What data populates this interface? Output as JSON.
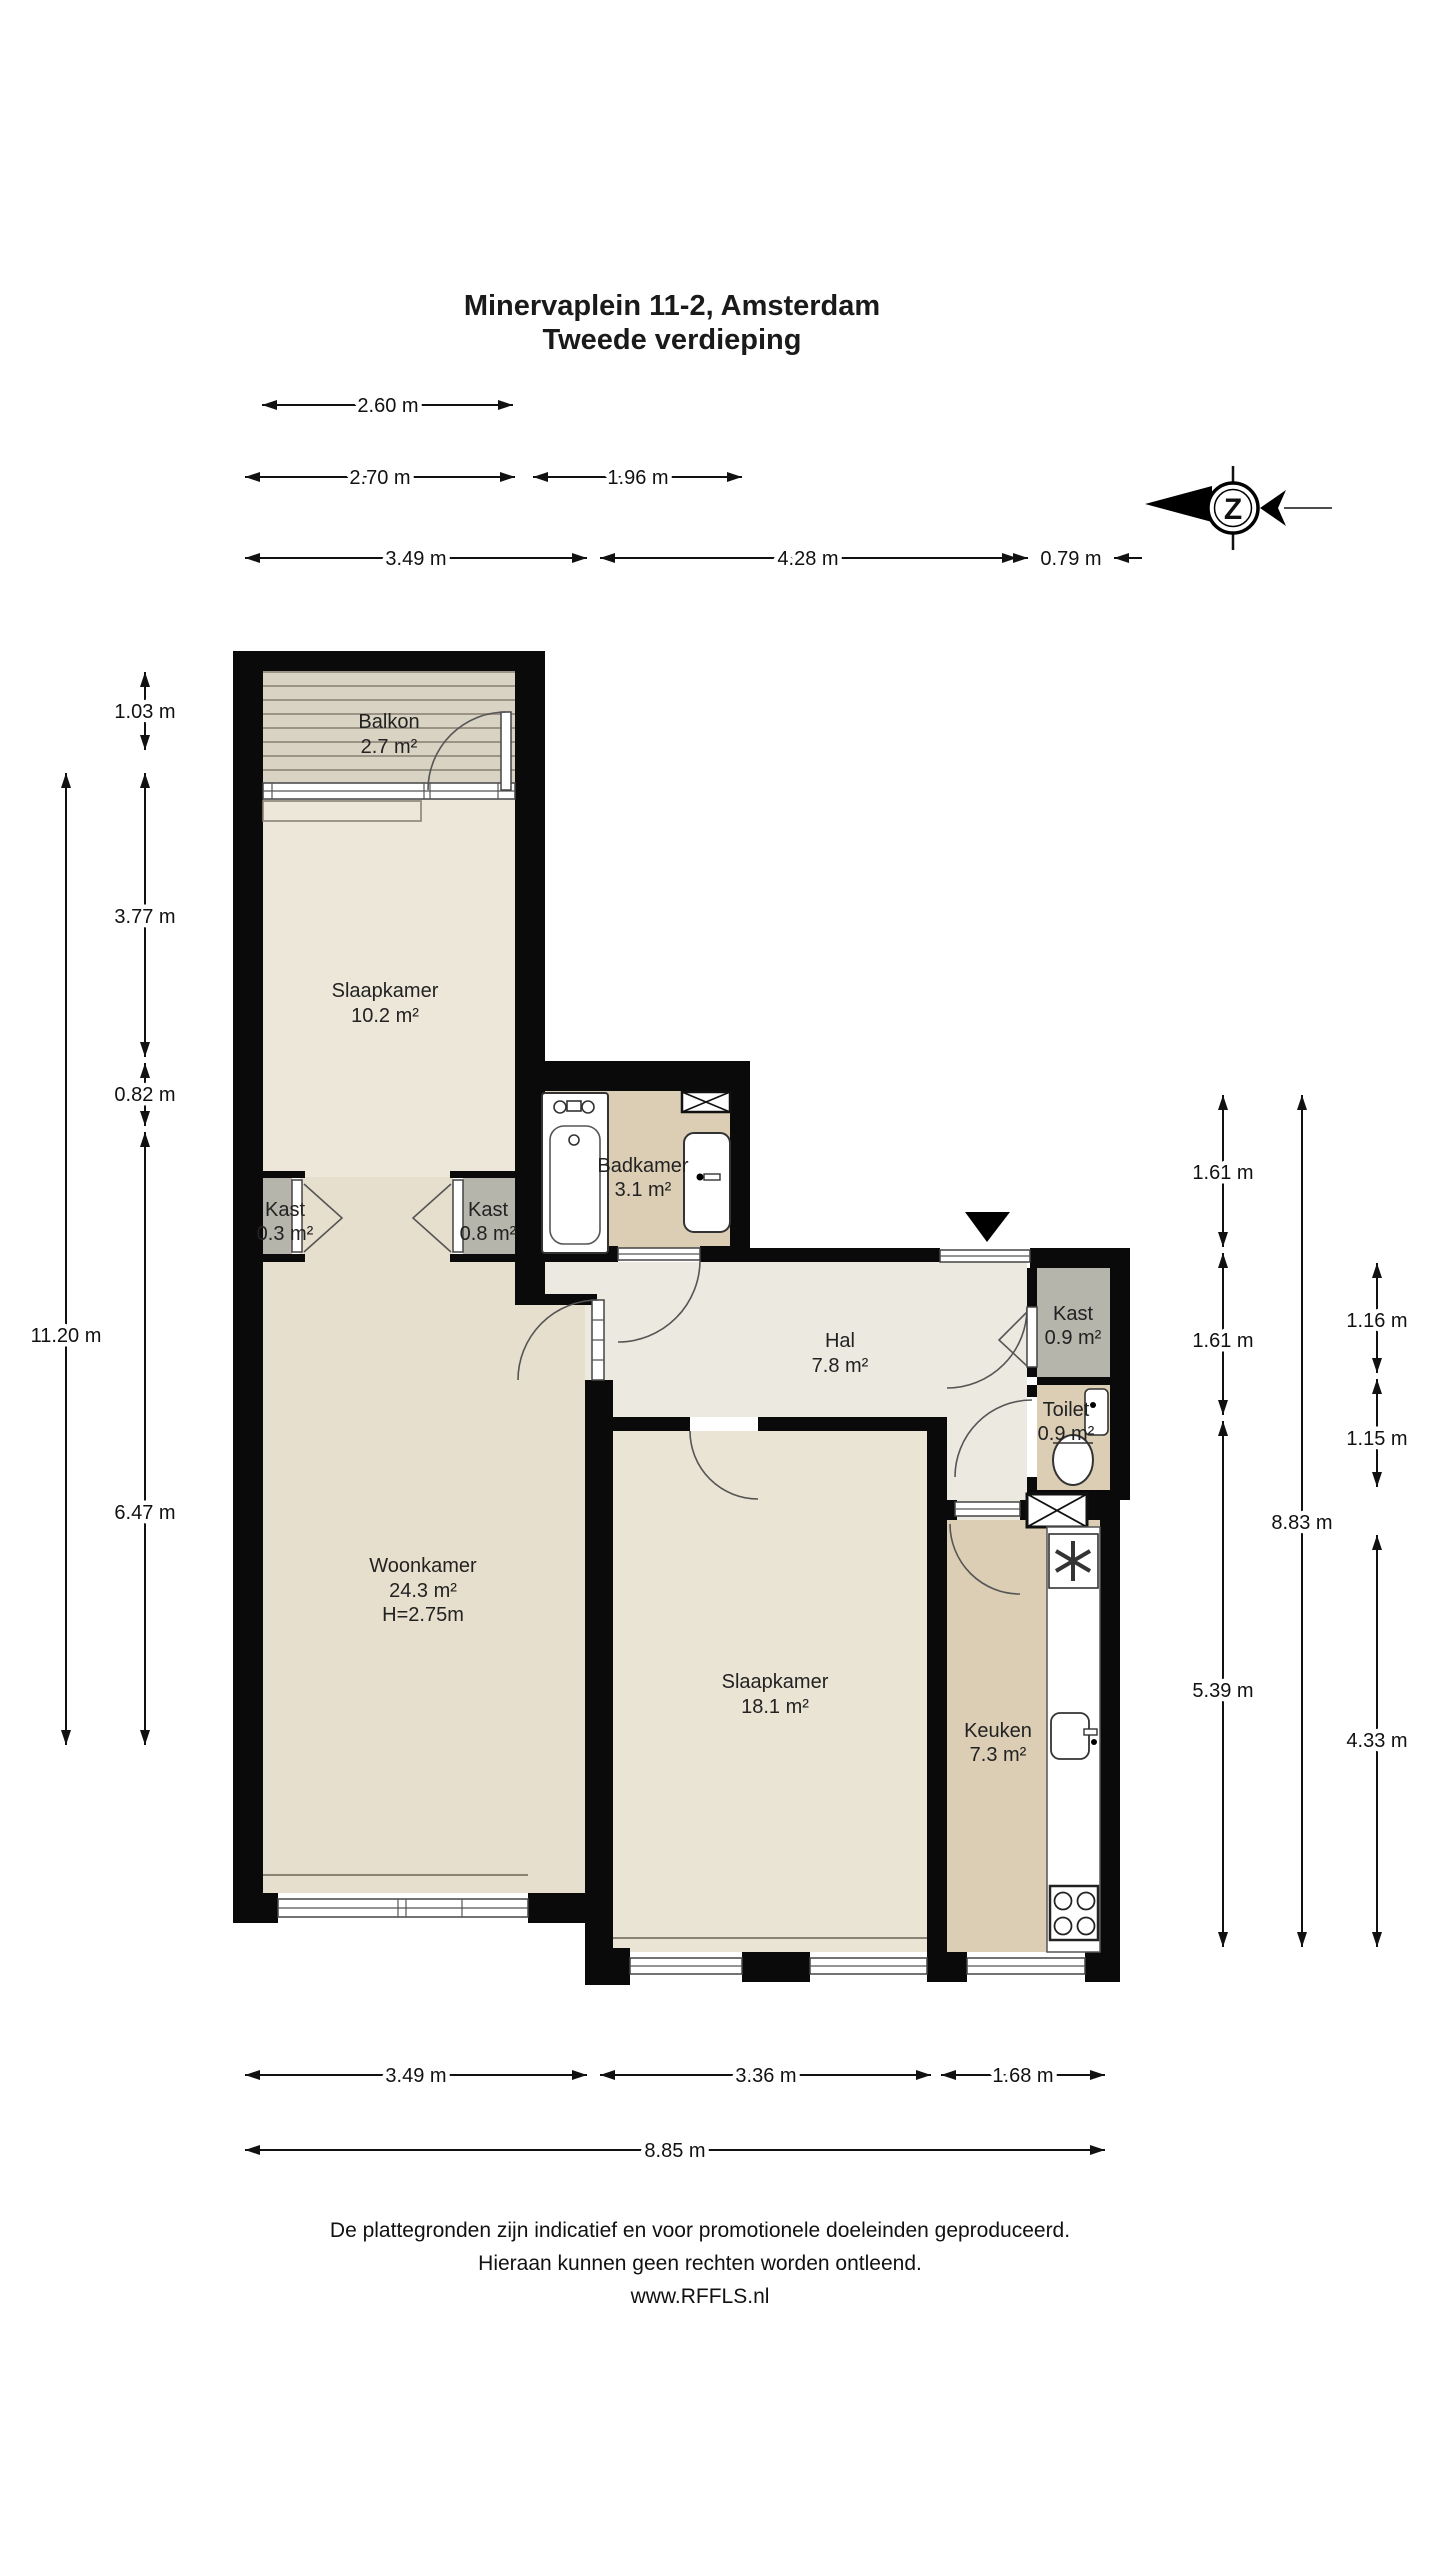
{
  "title": {
    "line1": "Minervaplein 11-2, Amsterdam",
    "line2": "Tweede verdieping"
  },
  "compass": {
    "letter": "Z"
  },
  "rooms": {
    "balkon": {
      "name": "Balkon",
      "area": "2.7 m²"
    },
    "slaapkamer1": {
      "name": "Slaapkamer",
      "area": "10.2 m²"
    },
    "kast1": {
      "name": "Kast",
      "area": "0.3 m²"
    },
    "kast2": {
      "name": "Kast",
      "area": "0.8 m²"
    },
    "badkamer": {
      "name": "Badkamer",
      "area": "3.1 m²"
    },
    "hal": {
      "name": "Hal",
      "area": "7.8 m²"
    },
    "kast3": {
      "name": "Kast",
      "area": "0.9 m²"
    },
    "toilet": {
      "name": "Toilet",
      "area": "0.9 m²"
    },
    "woonkamer": {
      "name": "Woonkamer",
      "area": "24.3 m²",
      "ceiling": "H=2.75m"
    },
    "slaapkamer2": {
      "name": "Slaapkamer",
      "area": "18.1 m²"
    },
    "keuken": {
      "name": "Keuken",
      "area": "7.3 m²"
    }
  },
  "dimensions": {
    "top": {
      "w_balkon": "2.60 m",
      "w_slaapkamer": "2.70 m",
      "w_badkamer": "1.96 m",
      "w_left": "3.49 m",
      "w_mid": "4.28 m",
      "w_right": "0.79 m"
    },
    "left": {
      "h_balkon": "1.03 m",
      "h_slaapkamer": "3.77 m",
      "h_kast": "0.82 m",
      "h_woonkamer": "6.47 m",
      "h_total": "11.20 m"
    },
    "right": {
      "h_badkamer": "1.61 m",
      "h_hal": "1.61 m",
      "h_slaapkamer": "5.39 m",
      "h_total": "8.83 m",
      "h_kast": "1.16 m",
      "h_toilet": "1.15 m",
      "h_keuken": "4.33 m"
    },
    "bottom": {
      "w_woonkamer": "3.49 m",
      "w_slaapkamer": "3.36 m",
      "w_keuken": "1.68 m",
      "w_total": "8.85 m"
    }
  },
  "footer": {
    "line1": "De plattegronden zijn indicatief en voor promotionele doeleinden geproduceerd.",
    "line2": "Hieraan kunnen geen rechten worden ontleend.",
    "line3": "www.RFFLS.nl"
  },
  "colors": {
    "wall": "#0a0a0a",
    "slaapkamer": "#ece7d8",
    "woonkamer": "#e7dfcd",
    "slaapkamer2": "#eae4d4",
    "hal": "#ebe9e0",
    "wet_room": "#dbceb5",
    "closet": "#b5b5ab",
    "balcony": "#d9d3c3",
    "balcony_stripe": "#9a9386"
  }
}
